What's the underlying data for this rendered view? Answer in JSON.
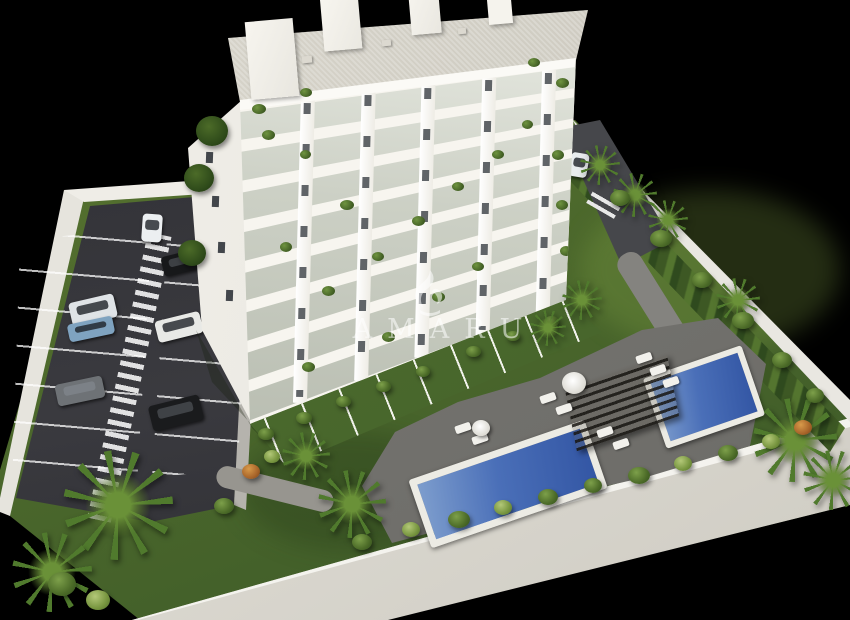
{
  "canvas": {
    "width": 850,
    "height": 620,
    "background_color": "#000000"
  },
  "watermark": {
    "text": "AMARU",
    "logo": "amaru-bird-logo",
    "color": "rgba(255,255,255,0.55)"
  },
  "scene": {
    "type": "aerial-3d-architectural-render",
    "subject": "white residential apartment building with landscaped grounds",
    "building": {
      "visible_floors": 8,
      "facade_color": "#f6f4ee",
      "roof_terrace_color": "#d8d5cb",
      "balcony_glass_color": "#b9beb0",
      "roof_structures": 4
    },
    "parking_lot": {
      "surface_color": "#333338",
      "marking_color": "#ffffff",
      "car_colors": [
        "white",
        "black",
        "silver",
        "blue",
        "white",
        "gray",
        "black",
        "white"
      ]
    },
    "swimming_pools": [
      {
        "name": "main-pool",
        "water_color": "#3d63ae",
        "surround_color": "#ecebe4"
      },
      {
        "name": "upper-pool",
        "water_color": "#3d63ae",
        "surround_color": "#ecebe4"
      }
    ],
    "pergola_color": "#36332c",
    "lawn_color": "#4e6a2c",
    "perimeter_wall_color": "#dddbd3",
    "pool_deck_color": "#72716d"
  }
}
